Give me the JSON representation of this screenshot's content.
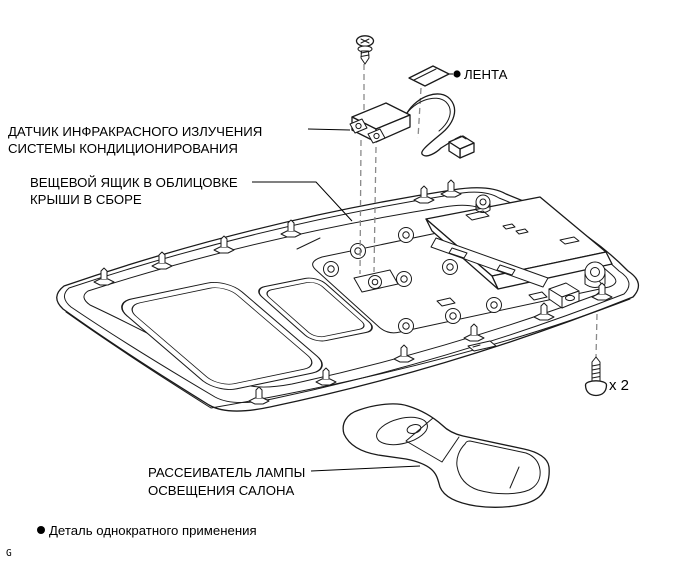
{
  "diagram_type": "exploded-parts-view",
  "colors": {
    "background": "#ffffff",
    "line_art": "#1a1a1a",
    "guide_dashes": "#8a8a8a",
    "text": "#000000"
  },
  "callouts": {
    "tape": {
      "text": "ЛЕНТА",
      "single_use_bullet": true
    },
    "ir_sensor": {
      "line1": "ДАТЧИК ИНФРАКРАСНОГО ИЗЛУЧЕНИЯ",
      "line2": "СИСТЕМЫ КОНДИЦИОНИРОВАНИЯ"
    },
    "roof_box": {
      "line1": "ВЕЩЕВОЙ ЯЩИК В ОБЛИЦОВКЕ",
      "line2": "КРЫШИ В СБОРЕ"
    },
    "lamp_lens": {
      "line1": "РАССЕИВАТЕЛЬ ЛАМПЫ",
      "line2": "ОСВЕЩЕНИЯ САЛОНА"
    },
    "screw_quantity": "x 2"
  },
  "footnote": {
    "text": "Деталь однократного применения"
  },
  "page_marker": "G"
}
